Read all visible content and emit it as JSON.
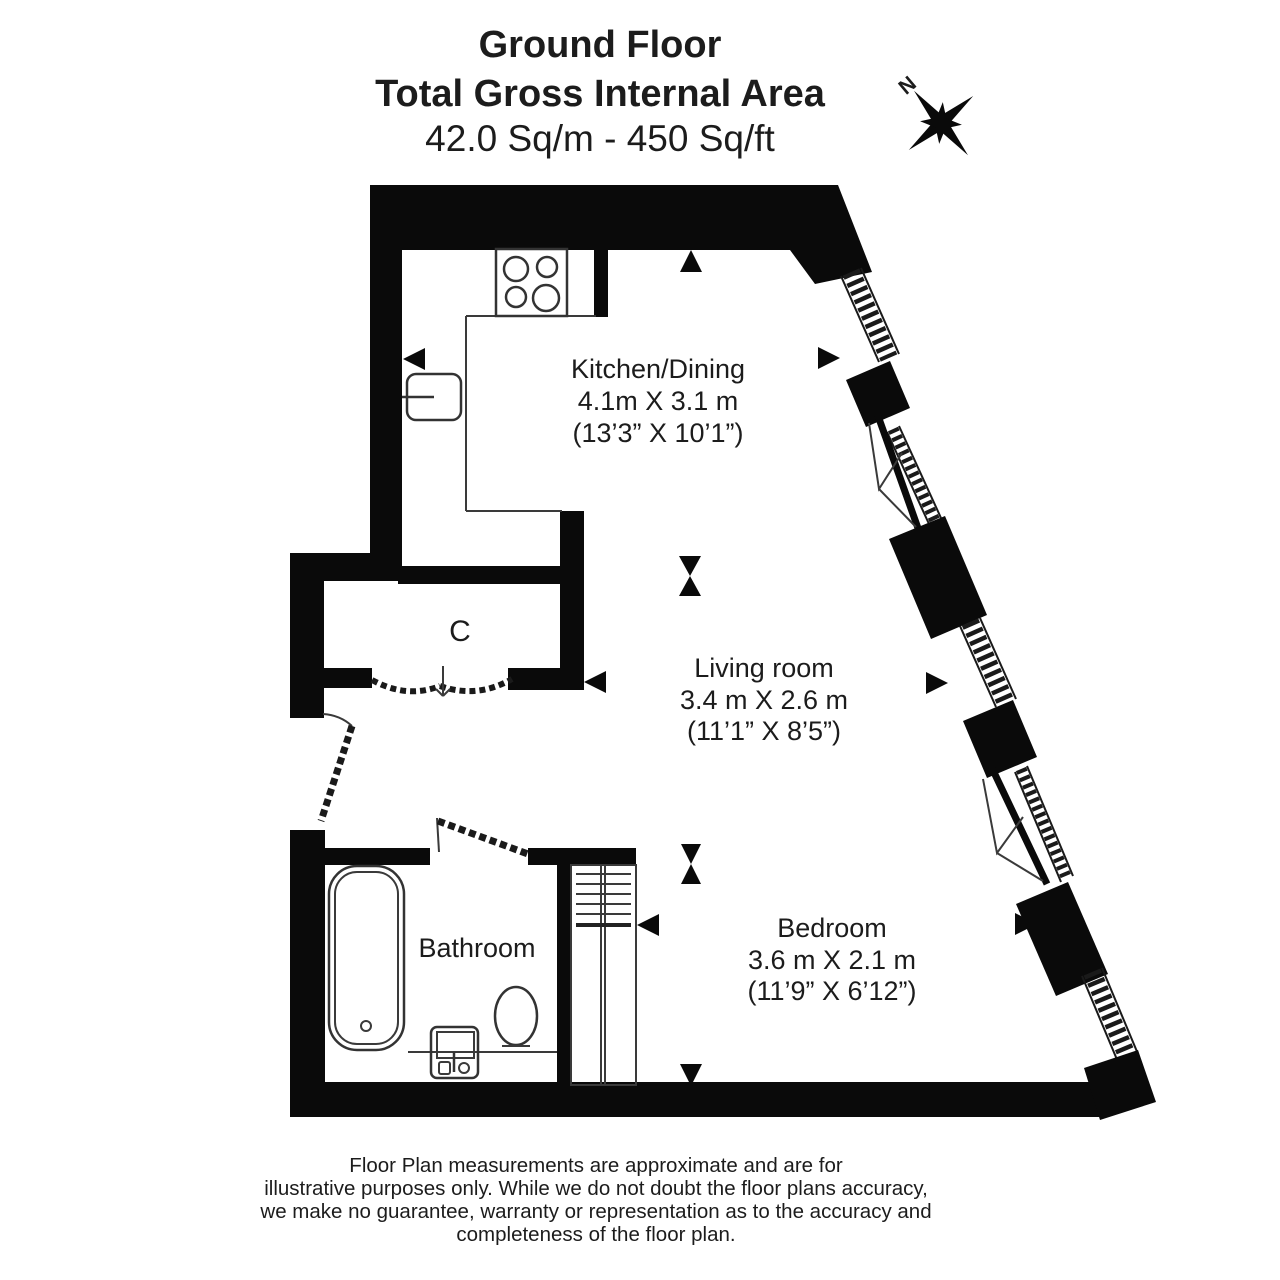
{
  "title": {
    "line1": "Ground Floor",
    "line2": "Total Gross Internal Area",
    "line3": "42.0 Sq/m - 450 Sq/ft"
  },
  "compass": {
    "north_label": "N"
  },
  "rooms": {
    "kitchen_dining": {
      "name": "Kitchen/Dining",
      "size_metric": "4.1m X 3.1 m",
      "size_imperial": "(13’3” X 10’1”)"
    },
    "living_room": {
      "name": "Living room",
      "size_metric": "3.4 m X 2.6 m",
      "size_imperial": "(11’1” X 8’5”)"
    },
    "bedroom": {
      "name": "Bedroom",
      "size_metric": "3.6 m X 2.1 m",
      "size_imperial": "(11’9” X 6’12”)"
    },
    "bathroom": {
      "name": "Bathroom"
    },
    "cupboard": {
      "name": "C"
    }
  },
  "footer": {
    "line1": "Floor Plan measurements are approximate and are for",
    "line2": "illustrative purposes only.  While we do not doubt the floor plans accuracy,",
    "line3": "we make no guarantee, warranty or representation as to the accuracy and",
    "line4": "completeness of the floor plan."
  },
  "colors": {
    "wall": "#0a0a0a",
    "background": "#ffffff",
    "text": "#1c1c1c"
  }
}
